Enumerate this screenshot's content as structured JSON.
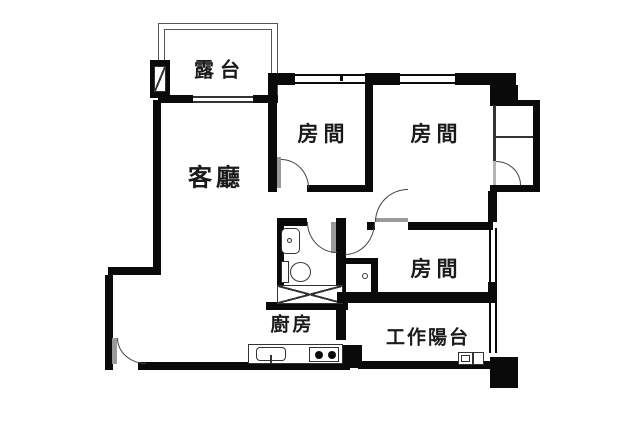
{
  "plan_title": "apartment-floor-plan",
  "rooms": [
    {
      "id": "terrace",
      "label": "露台"
    },
    {
      "id": "living-room",
      "label": "客廳"
    },
    {
      "id": "bedroom-1",
      "label": "房間"
    },
    {
      "id": "bedroom-2",
      "label": "房間"
    },
    {
      "id": "bedroom-3",
      "label": "房間"
    },
    {
      "id": "kitchen",
      "label": "廚房"
    },
    {
      "id": "work-balcony",
      "label": "工作陽台"
    }
  ],
  "colors": {
    "wall": "#0a0a0a",
    "line": "#333333",
    "door_leaf": "#9a9a9a",
    "background": "#ffffff"
  }
}
